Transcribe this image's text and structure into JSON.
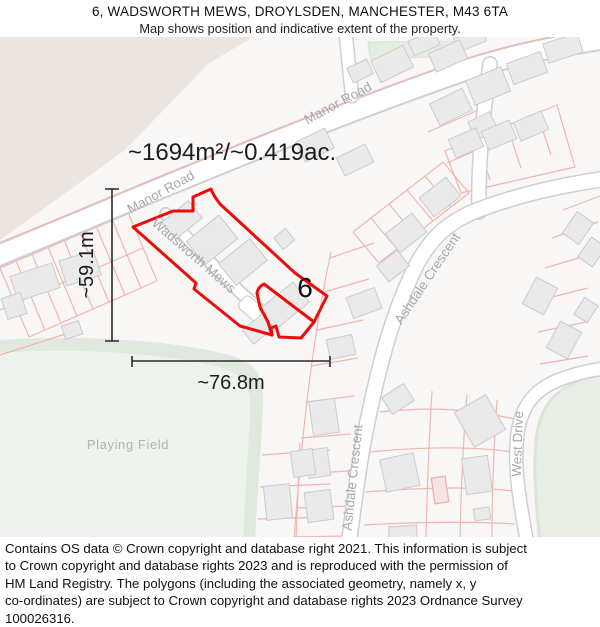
{
  "header": {
    "title": "6, WADSWORTH MEWS, DROYLSDEN, MANCHESTER, M43 6TA",
    "subtitle": "Map shows position and indicative extent of the property."
  },
  "map": {
    "area_label": "~1694m²/~0.419ac.",
    "plot_number": "6",
    "height_label": "~59.1m",
    "width_label": "~76.8m",
    "roads": {
      "manor_road": "Manor Road",
      "wadsworth_mews": "Wadsworth Mews",
      "ashdale_crescent": "Ashdale Crescent",
      "west_drive": "West Drive"
    },
    "places": {
      "playing_field": "Playing Field"
    },
    "colors": {
      "property_outline": "#ed0c0c",
      "measurement": "#2a2a2a",
      "road_label": "#a9a9a9",
      "parcel_line": "#f2b5b1",
      "building_fill": "#eaeaea",
      "green_fill": "#edf2ec",
      "beige_fill": "#ece5e0"
    }
  },
  "footer": {
    "lines": [
      "Contains OS data © Crown copyright and database right 2021. This information is subject",
      "to Crown copyright and database rights 2023 and is reproduced with the permission of",
      "HM Land Registry. The polygons (including the associated geometry, namely x, y",
      "co-ordinates) are subject to Crown copyright and database rights 2023 Ordnance Survey",
      "100026316."
    ]
  }
}
